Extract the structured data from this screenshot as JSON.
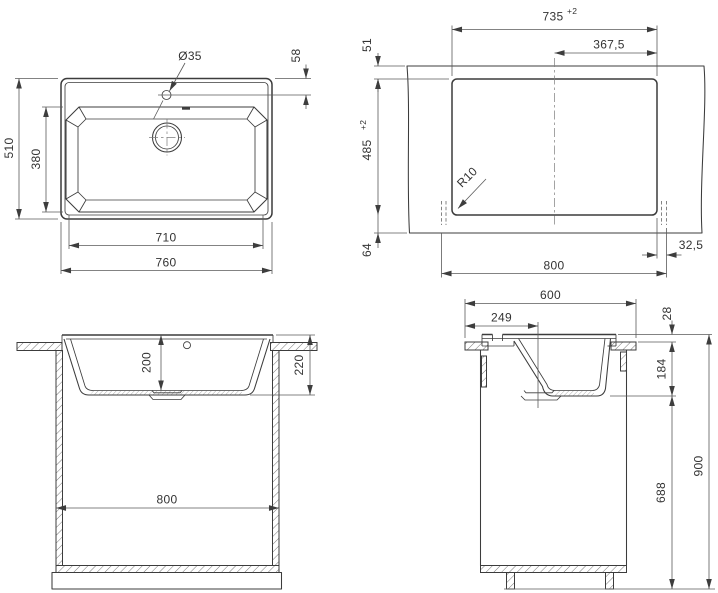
{
  "meta": {
    "background": "#ffffff",
    "line_color": "#3c3c3c",
    "dimension_line_color": "#5a5a5a"
  },
  "views": {
    "top_view": {
      "dims": {
        "outer_width": "760",
        "bowl_width": "710",
        "outer_depth": "510",
        "bowl_depth": "380",
        "faucet_hole_dia": "Ø35",
        "faucet_offset": "58"
      }
    },
    "cutout_view": {
      "dims": {
        "cutout_width": "735",
        "cutout_width_tol": "+2",
        "center_to_edge": "367,5",
        "back_clearance": "51",
        "cutout_depth": "485",
        "cutout_depth_tol": "+2",
        "corner_radius": "R10",
        "front_clearance": "64",
        "cabinet_width": "800",
        "side_clearance": "32,5"
      }
    },
    "front_section_view": {
      "dims": {
        "bowl_inner_depth": "200",
        "sink_total_height": "220",
        "cabinet_width": "800"
      }
    },
    "side_section_view": {
      "dims": {
        "worktop_depth": "600",
        "drain_center_offset": "249",
        "rim_above_worktop": "28",
        "depth_below_worktop": "184",
        "cabinet_body_height": "688",
        "total_height": "900"
      }
    }
  }
}
